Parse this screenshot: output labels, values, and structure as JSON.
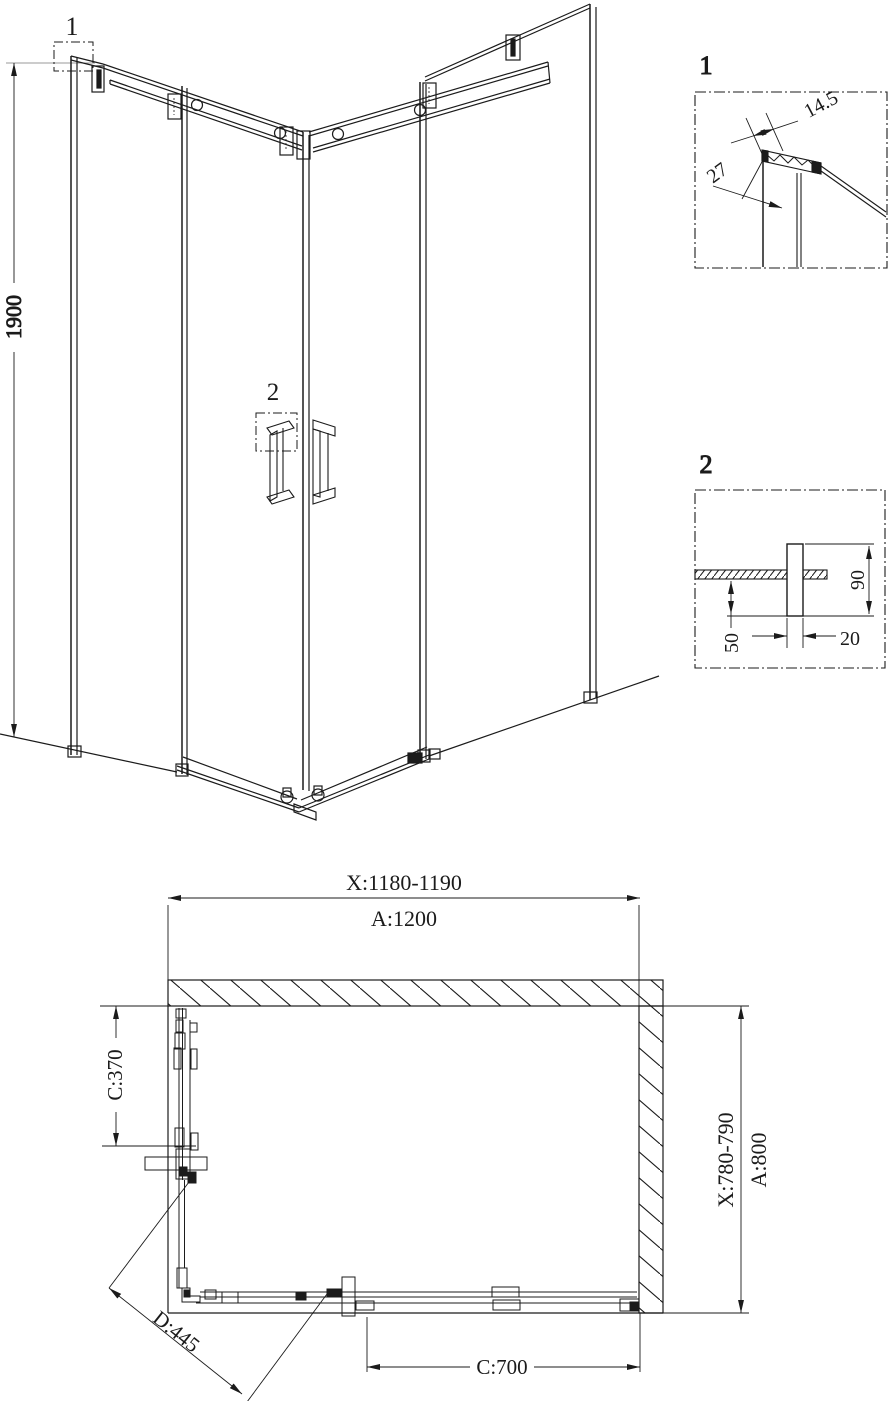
{
  "colors": {
    "ink": "#1b1b1b",
    "background": "#ffffff",
    "muted_line": "#9a9a9a"
  },
  "perspective": {
    "height": "1900",
    "callout_1": "1",
    "callout_2": "2"
  },
  "detail_1": {
    "label": "1",
    "width": "14.5",
    "depth": "27"
  },
  "detail_2": {
    "label": "2",
    "length": "90",
    "offset": "50",
    "width": "20"
  },
  "plan": {
    "top_range": "X:1180-1190",
    "top_nominal": "A:1200",
    "side_range": "X:780-790",
    "side_nominal": "A:800",
    "left_offset": "C:370",
    "diagonal": "D:445",
    "bottom_offset": "C:700"
  }
}
